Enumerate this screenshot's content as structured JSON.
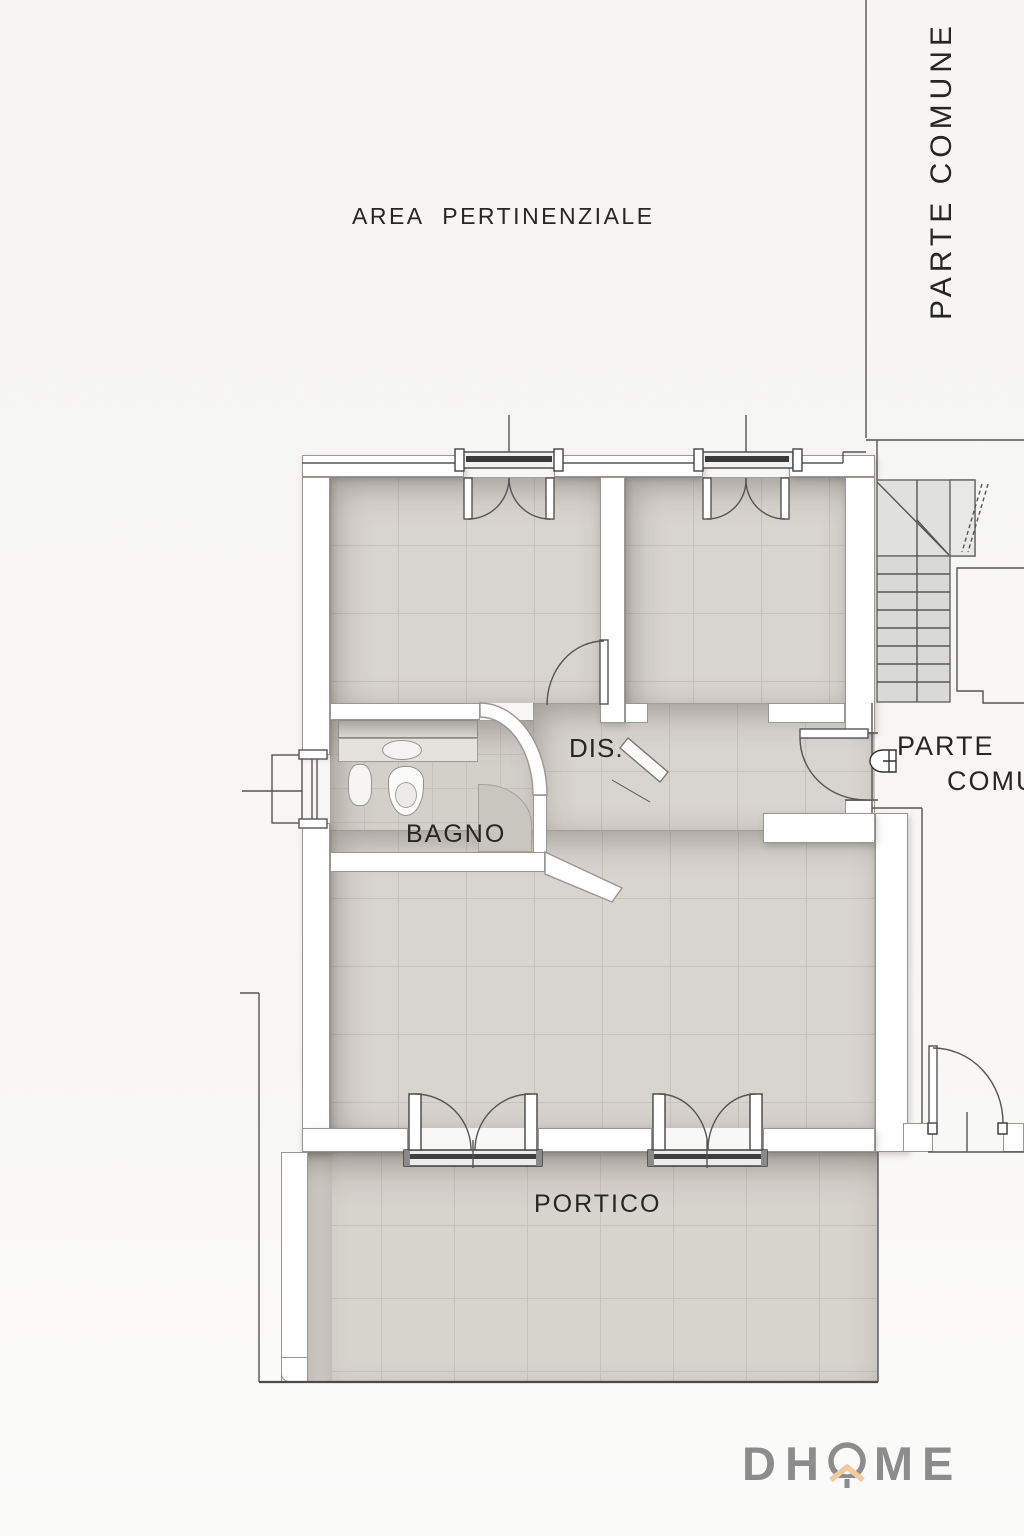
{
  "labels": {
    "area_pertinenziale": "AREA PERTINENZIALE",
    "parte_comune_vertical": "PARTE COMUNE",
    "parte_comune_line1": "PARTE",
    "parte_comune_line2": "COMUNE",
    "dis": "DIS.",
    "bagno": "BAGNO",
    "portico": "PORTICO"
  },
  "logo": {
    "name": "DHOME",
    "prefix": "DH",
    "suffix": "ME",
    "letter_color": "#8c8c8c",
    "accent_color": "#f2c9a0"
  },
  "colors": {
    "background": "#f6f5f3",
    "floor_tile": "#d8d4cf",
    "grout": "#c6c2bc",
    "wall": "#fefefe",
    "linework": "#555555",
    "text": "#262626"
  },
  "rooms": [
    {
      "name": "camera-1",
      "label": ""
    },
    {
      "name": "camera-2",
      "label": ""
    },
    {
      "name": "bagno",
      "label": "BAGNO"
    },
    {
      "name": "disimpegno",
      "label": "DIS."
    },
    {
      "name": "soggiorno",
      "label": ""
    },
    {
      "name": "portico",
      "label": "PORTICO"
    },
    {
      "name": "parte-comune-stairwell",
      "label": "PARTE COMUNE"
    }
  ]
}
